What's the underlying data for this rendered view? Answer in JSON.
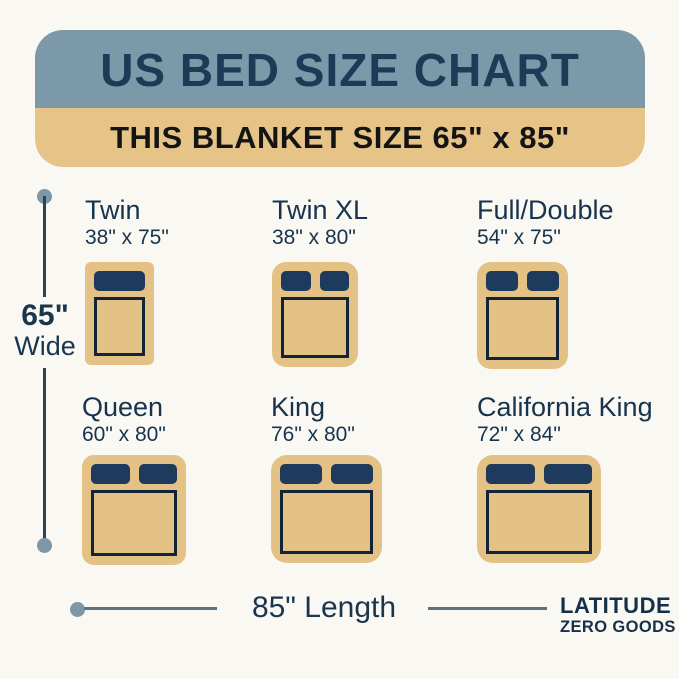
{
  "header": {
    "title": "US BED SIZE CHART",
    "subtitle": "THIS BLANKET SIZE 65\" x 85\""
  },
  "dimensions": {
    "width_value": "65\"",
    "width_unit": "Wide",
    "length_label": "85\" Length"
  },
  "beds": [
    {
      "id": "twin",
      "name": "Twin",
      "size": "38\" x 75\"",
      "pillows": 1,
      "w": 69,
      "h": 103,
      "radius": 6
    },
    {
      "id": "twin-xl",
      "name": "Twin XL",
      "size": "38\" x 80\"",
      "pillows": 2,
      "w": 86,
      "h": 105,
      "radius": 14
    },
    {
      "id": "full-double",
      "name": "Full/Double",
      "size": "54\" x 75\"",
      "pillows": 2,
      "w": 91,
      "h": 107,
      "radius": 14
    },
    {
      "id": "queen",
      "name": "Queen",
      "size": "60\" x 80\"",
      "pillows": 2,
      "w": 104,
      "h": 110,
      "radius": 12
    },
    {
      "id": "king",
      "name": "King",
      "size": "76\" x 80\"",
      "pillows": 2,
      "w": 111,
      "h": 108,
      "radius": 16
    },
    {
      "id": "california-king",
      "name": "California King",
      "size": "72\" x 84\"",
      "pillows": 2,
      "w": 124,
      "h": 108,
      "radius": 16
    }
  ],
  "logo": {
    "line1": "LATITUDE",
    "line2": "ZERO GOODS"
  },
  "colors": {
    "header_blue": "#7b99a9",
    "band_tan": "#e6c488",
    "bed_tan": "#e4c185",
    "navy_text": "#1d3a57",
    "pillow_navy": "#1e3a5c",
    "sheet_outline": "#10253a",
    "dot_blue": "#7d97a7",
    "background": "#faf8f3"
  }
}
